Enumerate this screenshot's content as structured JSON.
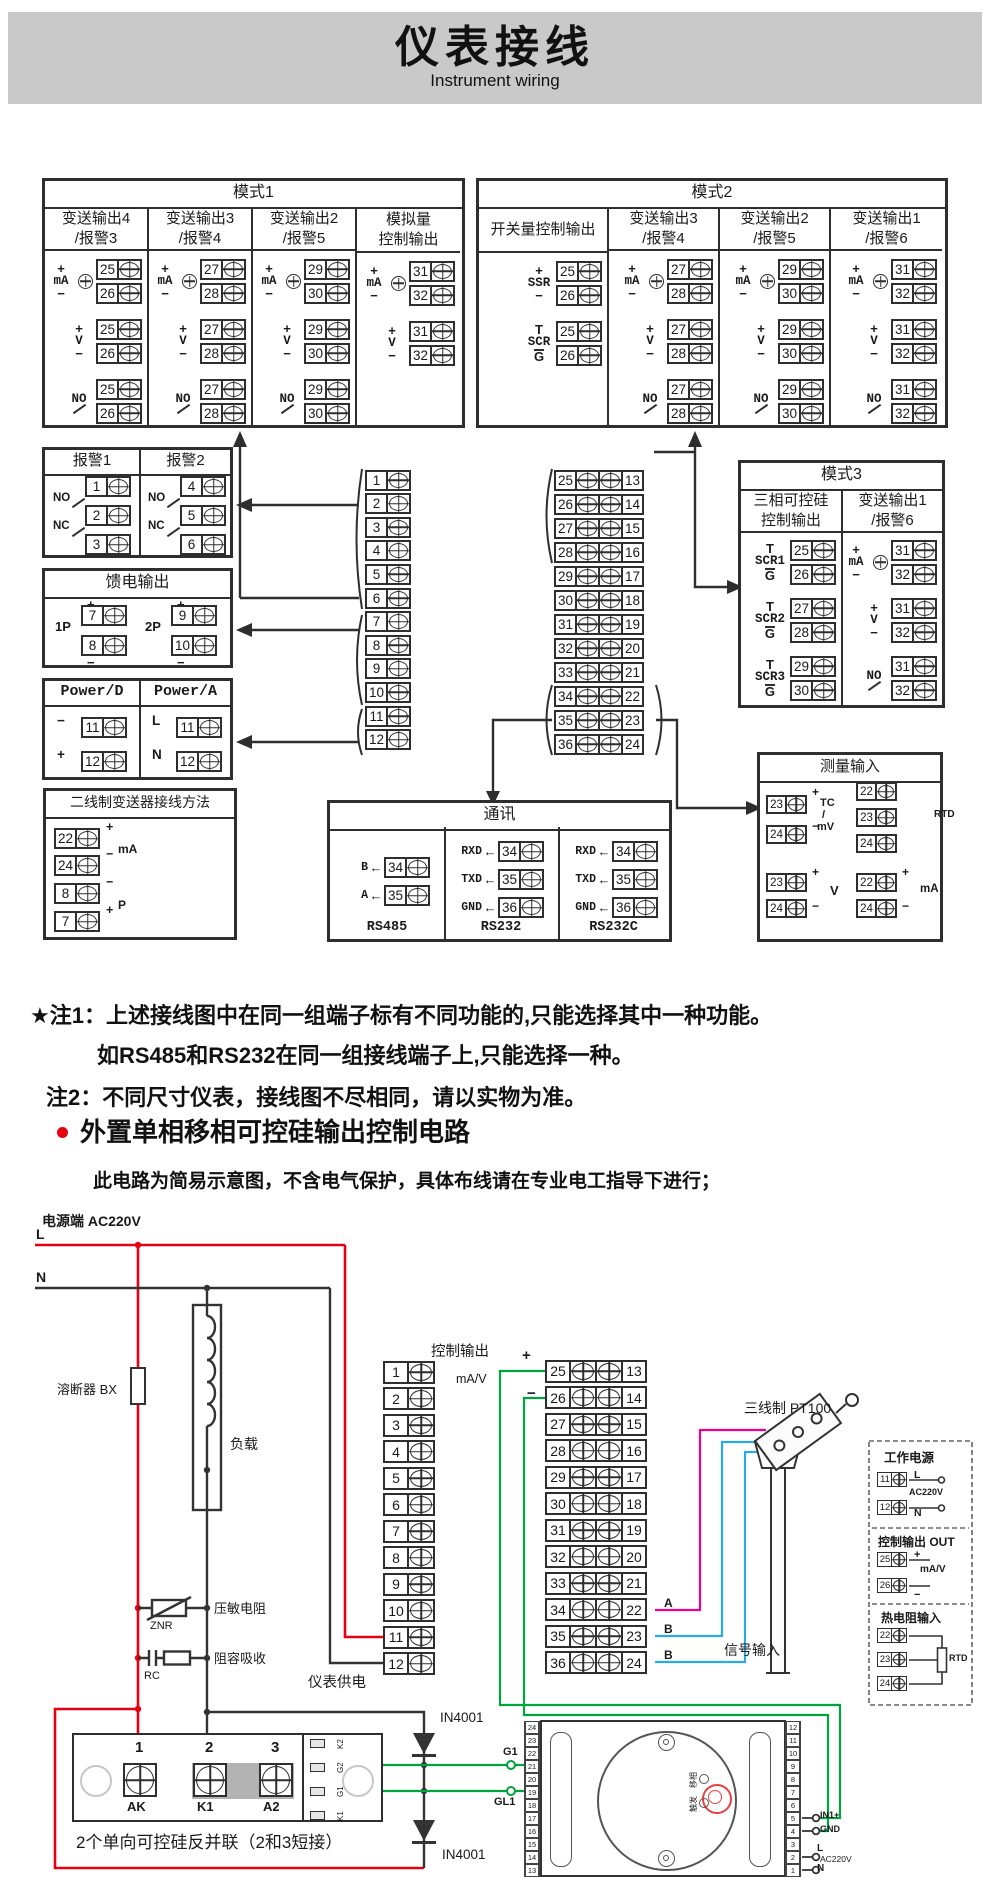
{
  "header": {
    "title": "仪表接线",
    "subtitle": "Instrument wiring"
  },
  "colors": {
    "accent_red": "#e60012",
    "wire_green": "#00a33e",
    "wire_cyan": "#29abe2",
    "wire_magenta": "#ec008c",
    "banner_bg": "#c9c9c9"
  },
  "mode1": {
    "title": "模式1",
    "columns": [
      {
        "t1": "变送输出4",
        "t2": "/报警3",
        "sections": [
          {
            "kind": "mA",
            "top": "+",
            "bottom": "−",
            "t1": "25",
            "t2": "26"
          },
          {
            "kind": "V",
            "top": "+",
            "bottom": "−",
            "t1": "25",
            "t2": "26"
          },
          {
            "kind": "NO",
            "t1": "25",
            "t2": "26"
          }
        ]
      },
      {
        "t1": "变送输出3",
        "t2": "/报警4",
        "sections": [
          {
            "kind": "mA",
            "top": "+",
            "bottom": "−",
            "t1": "27",
            "t2": "28"
          },
          {
            "kind": "V",
            "top": "+",
            "bottom": "−",
            "t1": "27",
            "t2": "28"
          },
          {
            "kind": "NO",
            "t1": "27",
            "t2": "28"
          }
        ]
      },
      {
        "t1": "变送输出2",
        "t2": "/报警5",
        "sections": [
          {
            "kind": "mA",
            "top": "+",
            "bottom": "−",
            "t1": "29",
            "t2": "30"
          },
          {
            "kind": "V",
            "top": "+",
            "bottom": "−",
            "t1": "29",
            "t2": "30"
          },
          {
            "kind": "NO",
            "t1": "29",
            "t2": "30"
          }
        ]
      },
      {
        "t1": "模拟量",
        "t2": "控制输出",
        "sections": [
          {
            "kind": "mA",
            "top": "+",
            "bottom": "−",
            "t1": "31",
            "t2": "32"
          },
          {
            "kind": "V",
            "top": "+",
            "bottom": "−",
            "t1": "31",
            "t2": "32"
          }
        ]
      }
    ]
  },
  "mode2": {
    "title": "模式2",
    "columns": [
      {
        "t1": "开关量控制输出",
        "t2": "",
        "sections": [
          {
            "kind": "SSR",
            "top": "+",
            "bottom": "−",
            "t1": "25",
            "t2": "26"
          },
          {
            "kind": "SCR",
            "top": "T",
            "bottom": "G",
            "t1": "25",
            "t2": "26"
          }
        ]
      },
      {
        "t1": "变送输出3",
        "t2": "/报警4",
        "sections": [
          {
            "kind": "mA",
            "top": "+",
            "bottom": "−",
            "t1": "27",
            "t2": "28"
          },
          {
            "kind": "V",
            "top": "+",
            "bottom": "−",
            "t1": "27",
            "t2": "28"
          },
          {
            "kind": "NO",
            "t1": "27",
            "t2": "28"
          }
        ]
      },
      {
        "t1": "变送输出2",
        "t2": "/报警5",
        "sections": [
          {
            "kind": "mA",
            "top": "+",
            "bottom": "−",
            "t1": "29",
            "t2": "30"
          },
          {
            "kind": "V",
            "top": "+",
            "bottom": "−",
            "t1": "29",
            "t2": "30"
          },
          {
            "kind": "NO",
            "t1": "29",
            "t2": "30"
          }
        ]
      },
      {
        "t1": "变送输出1",
        "t2": "/报警6",
        "sections": [
          {
            "kind": "mA",
            "top": "+",
            "bottom": "−",
            "t1": "31",
            "t2": "32"
          },
          {
            "kind": "V",
            "top": "+",
            "bottom": "−",
            "t1": "31",
            "t2": "32"
          },
          {
            "kind": "NO",
            "t1": "31",
            "t2": "32"
          }
        ]
      }
    ]
  },
  "mode3": {
    "title": "模式3",
    "columns": [
      {
        "t1": "三相可控硅",
        "t2": "控制输出",
        "sections": [
          {
            "kind": "SCR1",
            "top": "T",
            "bottom": "G",
            "t1": "25",
            "t2": "26"
          },
          {
            "kind": "SCR2",
            "top": "T",
            "bottom": "G",
            "t1": "27",
            "t2": "28"
          },
          {
            "kind": "SCR3",
            "top": "T",
            "bottom": "G",
            "t1": "29",
            "t2": "30"
          }
        ]
      },
      {
        "t1": "变送输出1",
        "t2": "/报警6",
        "sections": [
          {
            "kind": "mA",
            "top": "+",
            "bottom": "−",
            "t1": "31",
            "t2": "32"
          },
          {
            "kind": "V",
            "top": "+",
            "bottom": "−",
            "t1": "31",
            "t2": "32"
          },
          {
            "kind": "NO",
            "t1": "31",
            "t2": "32"
          }
        ]
      }
    ]
  },
  "alarm": {
    "title1": "报警1",
    "title2": "报警2",
    "no": "NO",
    "nc": "NC",
    "col1": [
      "1",
      "2",
      "3"
    ],
    "col2": [
      "4",
      "5",
      "6"
    ]
  },
  "feed": {
    "title": "馈电输出",
    "g1": {
      "label": "1P",
      "ps": "+",
      "p": "7",
      "ms": "−",
      "m": "8"
    },
    "g2": {
      "label": "2P",
      "ps": "+",
      "p": "9",
      "ms": "−",
      "m": "10"
    }
  },
  "power": {
    "d_title": "Power/D",
    "a_title": "Power/A",
    "d": [
      {
        "s": "−",
        "t": "11"
      },
      {
        "s": "+",
        "t": "12"
      }
    ],
    "a": [
      {
        "s": "L",
        "t": "11"
      },
      {
        "s": "N",
        "t": "12"
      }
    ]
  },
  "twowire": {
    "title": "二线制变送器接线方法",
    "rows": [
      {
        "t": "22",
        "s": "+"
      },
      {
        "t": "24",
        "s": "−"
      },
      {
        "t": "8",
        "s": "−"
      },
      {
        "t": "7",
        "s": "+"
      }
    ],
    "mid1": "mA",
    "mid2": "P"
  },
  "strips": {
    "left": [
      "1",
      "2",
      "3",
      "4",
      "5",
      "6",
      "7",
      "8",
      "9",
      "10",
      "11",
      "12"
    ],
    "mid": [
      "25",
      "26",
      "27",
      "28",
      "29",
      "30",
      "31",
      "32",
      "33",
      "34",
      "35",
      "36"
    ],
    "right": [
      "13",
      "14",
      "15",
      "16",
      "17",
      "18",
      "19",
      "20",
      "21",
      "22",
      "23",
      "24"
    ]
  },
  "comm": {
    "title": "通讯",
    "groups": [
      {
        "name": "RS485",
        "rows": [
          {
            "l": "B",
            "t": "34"
          },
          {
            "l": "A",
            "t": "35"
          }
        ]
      },
      {
        "name": "RS232",
        "rows": [
          {
            "l": "RXD",
            "t": "34"
          },
          {
            "l": "TXD",
            "t": "35"
          },
          {
            "l": "GND",
            "t": "36"
          }
        ]
      },
      {
        "name": "RS232C",
        "rows": [
          {
            "l": "RXD",
            "t": "34"
          },
          {
            "l": "TXD",
            "t": "35"
          },
          {
            "l": "GND",
            "t": "36"
          }
        ]
      }
    ]
  },
  "measure": {
    "title": "测量输入",
    "tc": {
      "rows": [
        {
          "t": "23",
          "s": "+"
        },
        {
          "t": "24",
          "s": "−"
        }
      ],
      "l1": "TC",
      "l2": "/",
      "l3": "mV"
    },
    "rtd": {
      "t": [
        "22",
        "23",
        "24"
      ],
      "label": "RTD"
    },
    "v": {
      "rows": [
        {
          "t": "23",
          "s": "+"
        },
        {
          "t": "24",
          "s": "−"
        }
      ],
      "label": "V"
    },
    "ma": {
      "rows": [
        {
          "t": "22",
          "s": "+"
        },
        {
          "t": "24",
          "s": "−"
        }
      ],
      "label": "mA"
    }
  },
  "notes": {
    "n1": "★注1：上述接线图中在同一组端子标有不同功能的,只能选择其中一种功能。",
    "n1b": "如RS485和RS232在同一组接线端子上,只能选择一种。",
    "n2": "注2：不同尺寸仪表，接线图不尽相同，请以实物为准。"
  },
  "section2": {
    "heading": "外置单相移相可控硅输出控制电路",
    "subtext": "此电路为简易示意图，不含电气保护，具体布线请在专业电工指导下进行；"
  },
  "circuit": {
    "power_label": "电源端 AC220V",
    "l": "L",
    "n": "N",
    "fuse": "溶断器 BX",
    "load": "负载",
    "znr_label": "压敏电阻",
    "znr": "ZNR",
    "rc_label": "阻容吸收",
    "rc": "RC",
    "ctrl_label": "控制输出",
    "ctrl_plus": "+",
    "ctrl_unit": "mA/V",
    "ctrl_minus": "−",
    "pt100": "三线制 PT100",
    "wire_a": "A",
    "wire_b1": "B",
    "wire_b2": "B",
    "signal_in": "信号输入",
    "meter_supply": "仪表供电",
    "diode1": "IN4001",
    "diode2": "IN4001",
    "g1": "G1",
    "gl1": "GL1",
    "scr_note": "2个单向可控硅反并联（2和3短接）",
    "scr_nums": [
      "1",
      "2",
      "3"
    ],
    "scr_names": [
      "AK",
      "K1",
      "A2"
    ],
    "scr_side": [
      "K2",
      "G2",
      "G1",
      "K1"
    ],
    "dashed": {
      "wp_title": "工作电源",
      "wp": [
        {
          "t": "11",
          "l": "L"
        },
        {
          "t": "12",
          "l": "N"
        }
      ],
      "wp_mid": "AC220V",
      "co_title": "控制输出 OUT",
      "co": [
        {
          "t": "25",
          "l": "+"
        },
        {
          "t": "26",
          "l": "−"
        }
      ],
      "co_mid": "mA/V",
      "rtd_title": "热电阻输入",
      "rtd_t": [
        "22",
        "23",
        "24"
      ],
      "rtd_label": "RTD"
    },
    "trigger": {
      "left": [
        "24",
        "23",
        "22",
        "21",
        "20",
        "19",
        "18",
        "17",
        "16",
        "15",
        "14",
        "13"
      ],
      "right": [
        "12",
        "11",
        "10",
        "9",
        "8",
        "7",
        "6",
        "5",
        "4",
        "3",
        "2",
        "1"
      ],
      "in1": "IN1+",
      "gnd": "GND",
      "tl": "L",
      "ac": "AC220V",
      "tn": "N",
      "adj1": "移相",
      "adj2": "触发"
    }
  }
}
